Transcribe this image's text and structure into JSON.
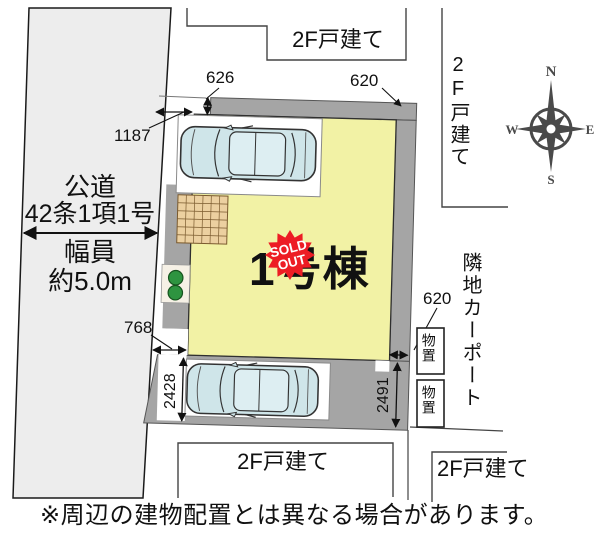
{
  "caption": "※周辺の建物配置とは異なる場合があります。",
  "road": {
    "name_line1": "公道",
    "name_line2": "42条1項1号",
    "width_line1": "幅員",
    "width_line2": "約5.0m"
  },
  "neighbors": {
    "top": "2F戸建て",
    "right": "2F戸建て",
    "bottom_left": "2F戸建て",
    "bottom_right": "2F戸建て",
    "carport": "隣地カーポート",
    "storage_1": "物置",
    "storage_2": "物置"
  },
  "building": {
    "name": "1号棟",
    "badge_line1": "SOLD",
    "badge_line2": "OUT"
  },
  "dims": {
    "north_strip": "626",
    "north_east_gap": "620",
    "west_front": "1187",
    "south_west_gap": "768",
    "parking_depth_left": "2428",
    "parking_depth_right": "2491",
    "east_gap": "620"
  },
  "compass": {
    "n": "N",
    "e": "E",
    "s": "S",
    "w": "W"
  },
  "colors": {
    "road_fill": "#ededed",
    "lot_concrete": "#a5a5a5",
    "building_fill": "#f2f2a5",
    "car_body": "#cfe5e9",
    "car_window": "#ddeef2",
    "badge_red": "#ed1c24",
    "bush_green": "#2e9440",
    "terrace_tan": "#ecd0a0",
    "compass_gray": "#4a4a4a",
    "line_black": "#111111"
  }
}
